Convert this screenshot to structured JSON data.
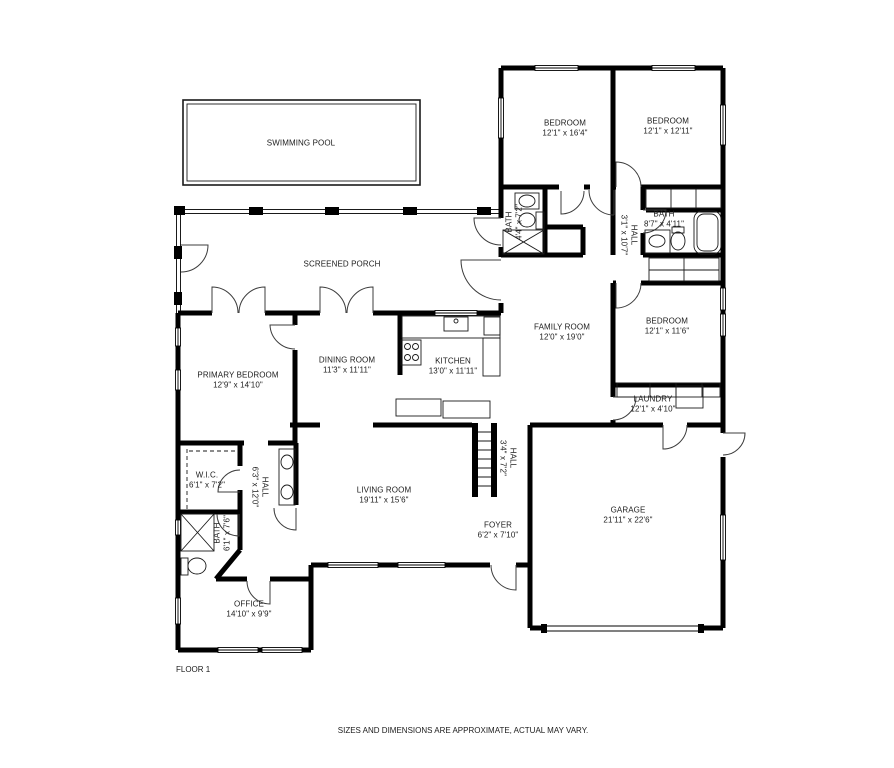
{
  "plan": {
    "floor_label": "FLOOR 1",
    "disclaimer": "SIZES AND DIMENSIONS ARE APPROXIMATE, ACTUAL MAY VARY.",
    "areas": {
      "swimming_pool": {
        "name": "SWIMMING POOL",
        "dims": ""
      },
      "screened_porch": {
        "name": "SCREENED PORCH",
        "dims": ""
      },
      "bedroom_1": {
        "name": "BEDROOM",
        "dims": "12'1\" x 16'4\""
      },
      "bedroom_2": {
        "name": "BEDROOM",
        "dims": "12'1\" x 12'11\""
      },
      "bath_1": {
        "name": "BATH",
        "dims": "4'4\" x 7'2\""
      },
      "hall_1": {
        "name": "HALL",
        "dims": "3'1\" x 10'7\""
      },
      "bath_2": {
        "name": "BATH",
        "dims": "8'7\" x 4'11\""
      },
      "bedroom_3": {
        "name": "BEDROOM",
        "dims": "12'1\" x 11'6\""
      },
      "laundry": {
        "name": "LAUNDRY",
        "dims": "12'1\" x 4'10\""
      },
      "family_room": {
        "name": "FAMILY ROOM",
        "dims": "12'0\" x 19'0\""
      },
      "dining_room": {
        "name": "DINING ROOM",
        "dims": "11'3\" x 11'11\""
      },
      "kitchen": {
        "name": "KITCHEN",
        "dims": "13'0\" x 11'11\""
      },
      "primary_bedroom": {
        "name": "PRIMARY BEDROOM",
        "dims": "12'9\" x 14'10\""
      },
      "wic": {
        "name": "W.I.C.",
        "dims": "6'1\" x 7'2\""
      },
      "hall_2": {
        "name": "HALL",
        "dims": "6'3\" x 12'0\""
      },
      "bath_3": {
        "name": "BATH",
        "dims": "6'1\" x 7'6\""
      },
      "living_room": {
        "name": "LIVING ROOM",
        "dims": "19'11\" x 15'6\""
      },
      "foyer": {
        "name": "FOYER",
        "dims": "6'2\" x 7'10\""
      },
      "hall_3": {
        "name": "HALL",
        "dims": "3'4\" x 7'2\""
      },
      "garage": {
        "name": "GARAGE",
        "dims": "21'11\" x 22'6\""
      },
      "office": {
        "name": "OFFICE",
        "dims": "14'10\" x 9'9\""
      }
    }
  }
}
